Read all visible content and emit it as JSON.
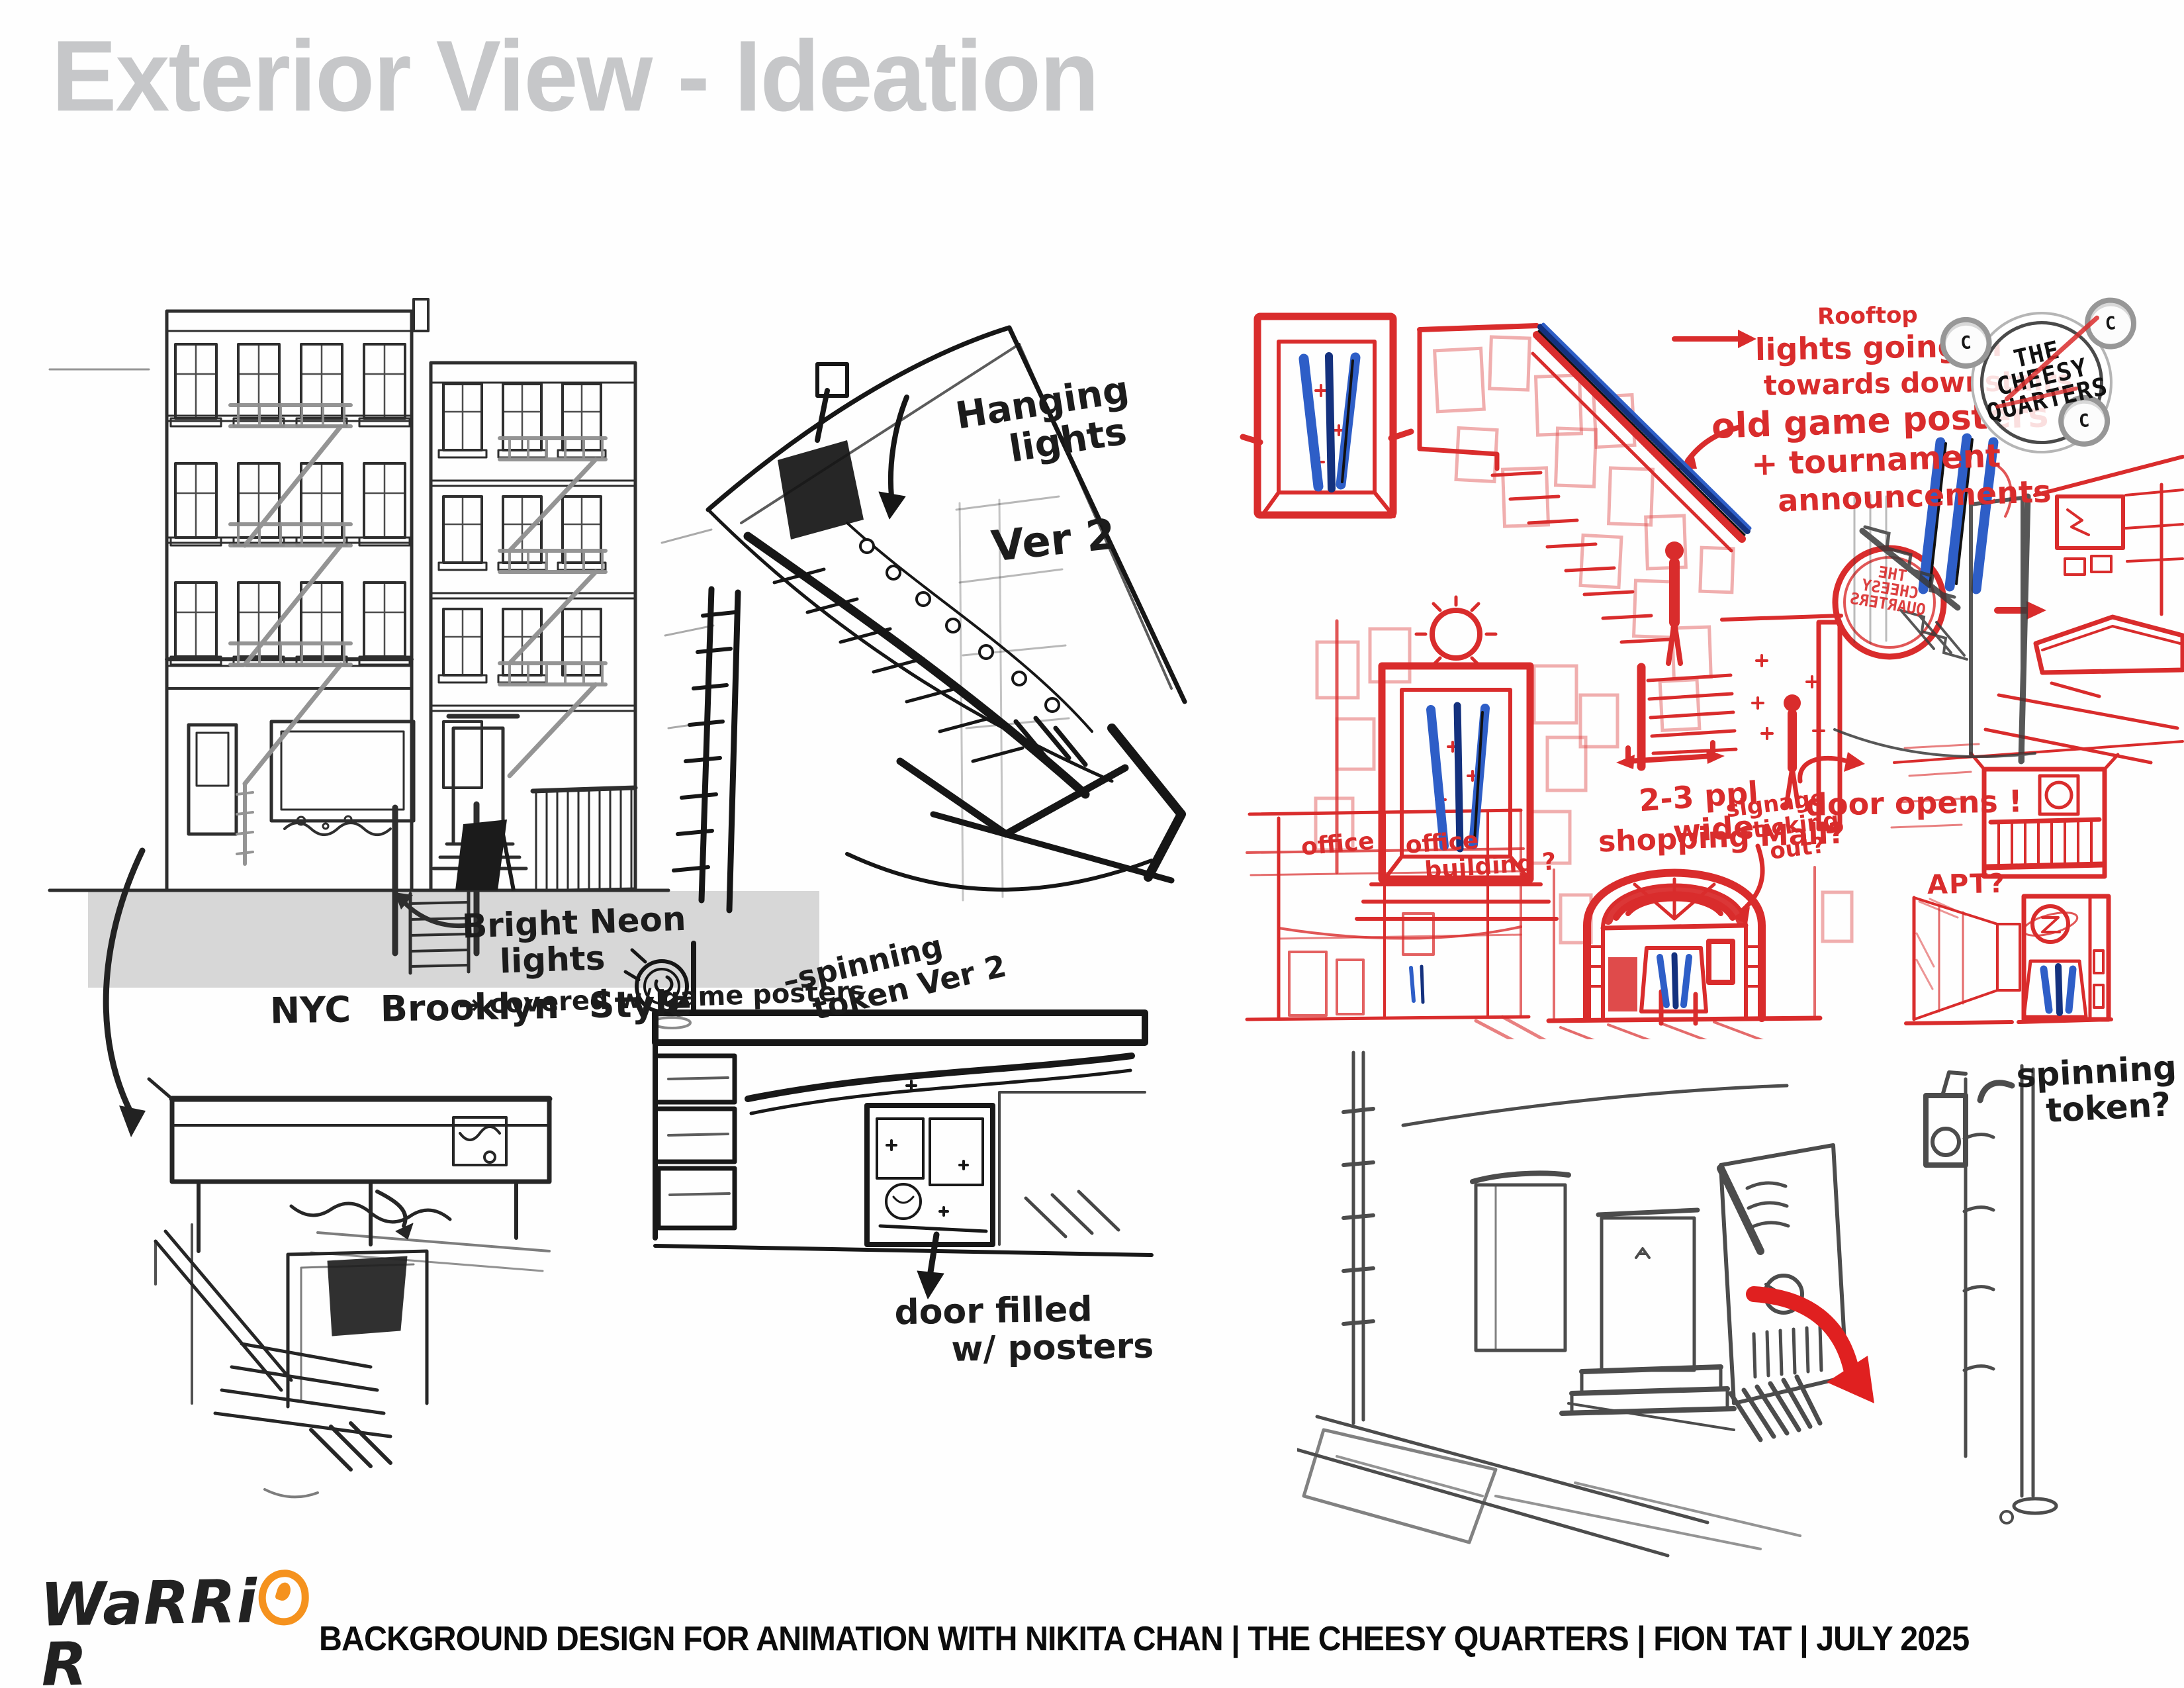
{
  "title": "Exterior View - Ideation",
  "colors": {
    "title_gray": "#C6C7C9",
    "accent_red": "#D92C2C",
    "accent_blue": "#2E5EC7",
    "logo_orange": "#F5921E",
    "pencil": "#2B2B2B",
    "band_gray": "#D7D7D7"
  },
  "annotations_black": {
    "bright_neon": {
      "line1": "Bright Neon",
      "line2": "lights",
      "line3": "→ covered w/ game posters"
    },
    "nyc_style": "NYC Brooklyn Style",
    "hanging_lights": {
      "line1": "Hanging",
      "line2": "lights"
    },
    "ver2": "Ver 2",
    "spinning_token_ver2": {
      "line1": "–spinning",
      "line2": "token Ver 2"
    },
    "door_posters": {
      "line1": "door filled",
      "line2": "w/ posters"
    },
    "spinning_token_q": {
      "line1": "spinning",
      "line2": "token?"
    }
  },
  "annotations_red": {
    "rooftop": {
      "line1": "Rooftop",
      "line2": "lights going in",
      "line3": "towards downstairs"
    },
    "old_game": {
      "line1": "old game posters",
      "line2": "+ tournament",
      "line3": "announcements"
    },
    "ppl_wide": {
      "line1": "2-3 ppl",
      "line2": "wide"
    },
    "signage": {
      "line1": "signage",
      "line2": "sticking",
      "line3": "out?"
    },
    "door_opens": "door opens !",
    "office": "office",
    "office_building": {
      "line1": "office",
      "line2": "building ?"
    },
    "shopping_mall": "shopping Mall?",
    "apt": "APT?"
  },
  "logos": {
    "cheesy": {
      "line1": "THE",
      "line2": "CHEESY",
      "line3": "QUARTERS",
      "coin_letter": "C"
    },
    "cheesy_mirrored": {
      "line1": "THE",
      "line2": "CHEESY",
      "line3": "QUARTERS"
    },
    "warrior": {
      "word_start": "WaRRi",
      "word_end": "R",
      "subtitle": "aRT camp"
    }
  },
  "footer": {
    "credits": "BACKGROUND DESIGN FOR ANIMATION WITH NIKITA CHAN | THE CHEESY QUARTERS | FION TAT | JULY 2025"
  }
}
